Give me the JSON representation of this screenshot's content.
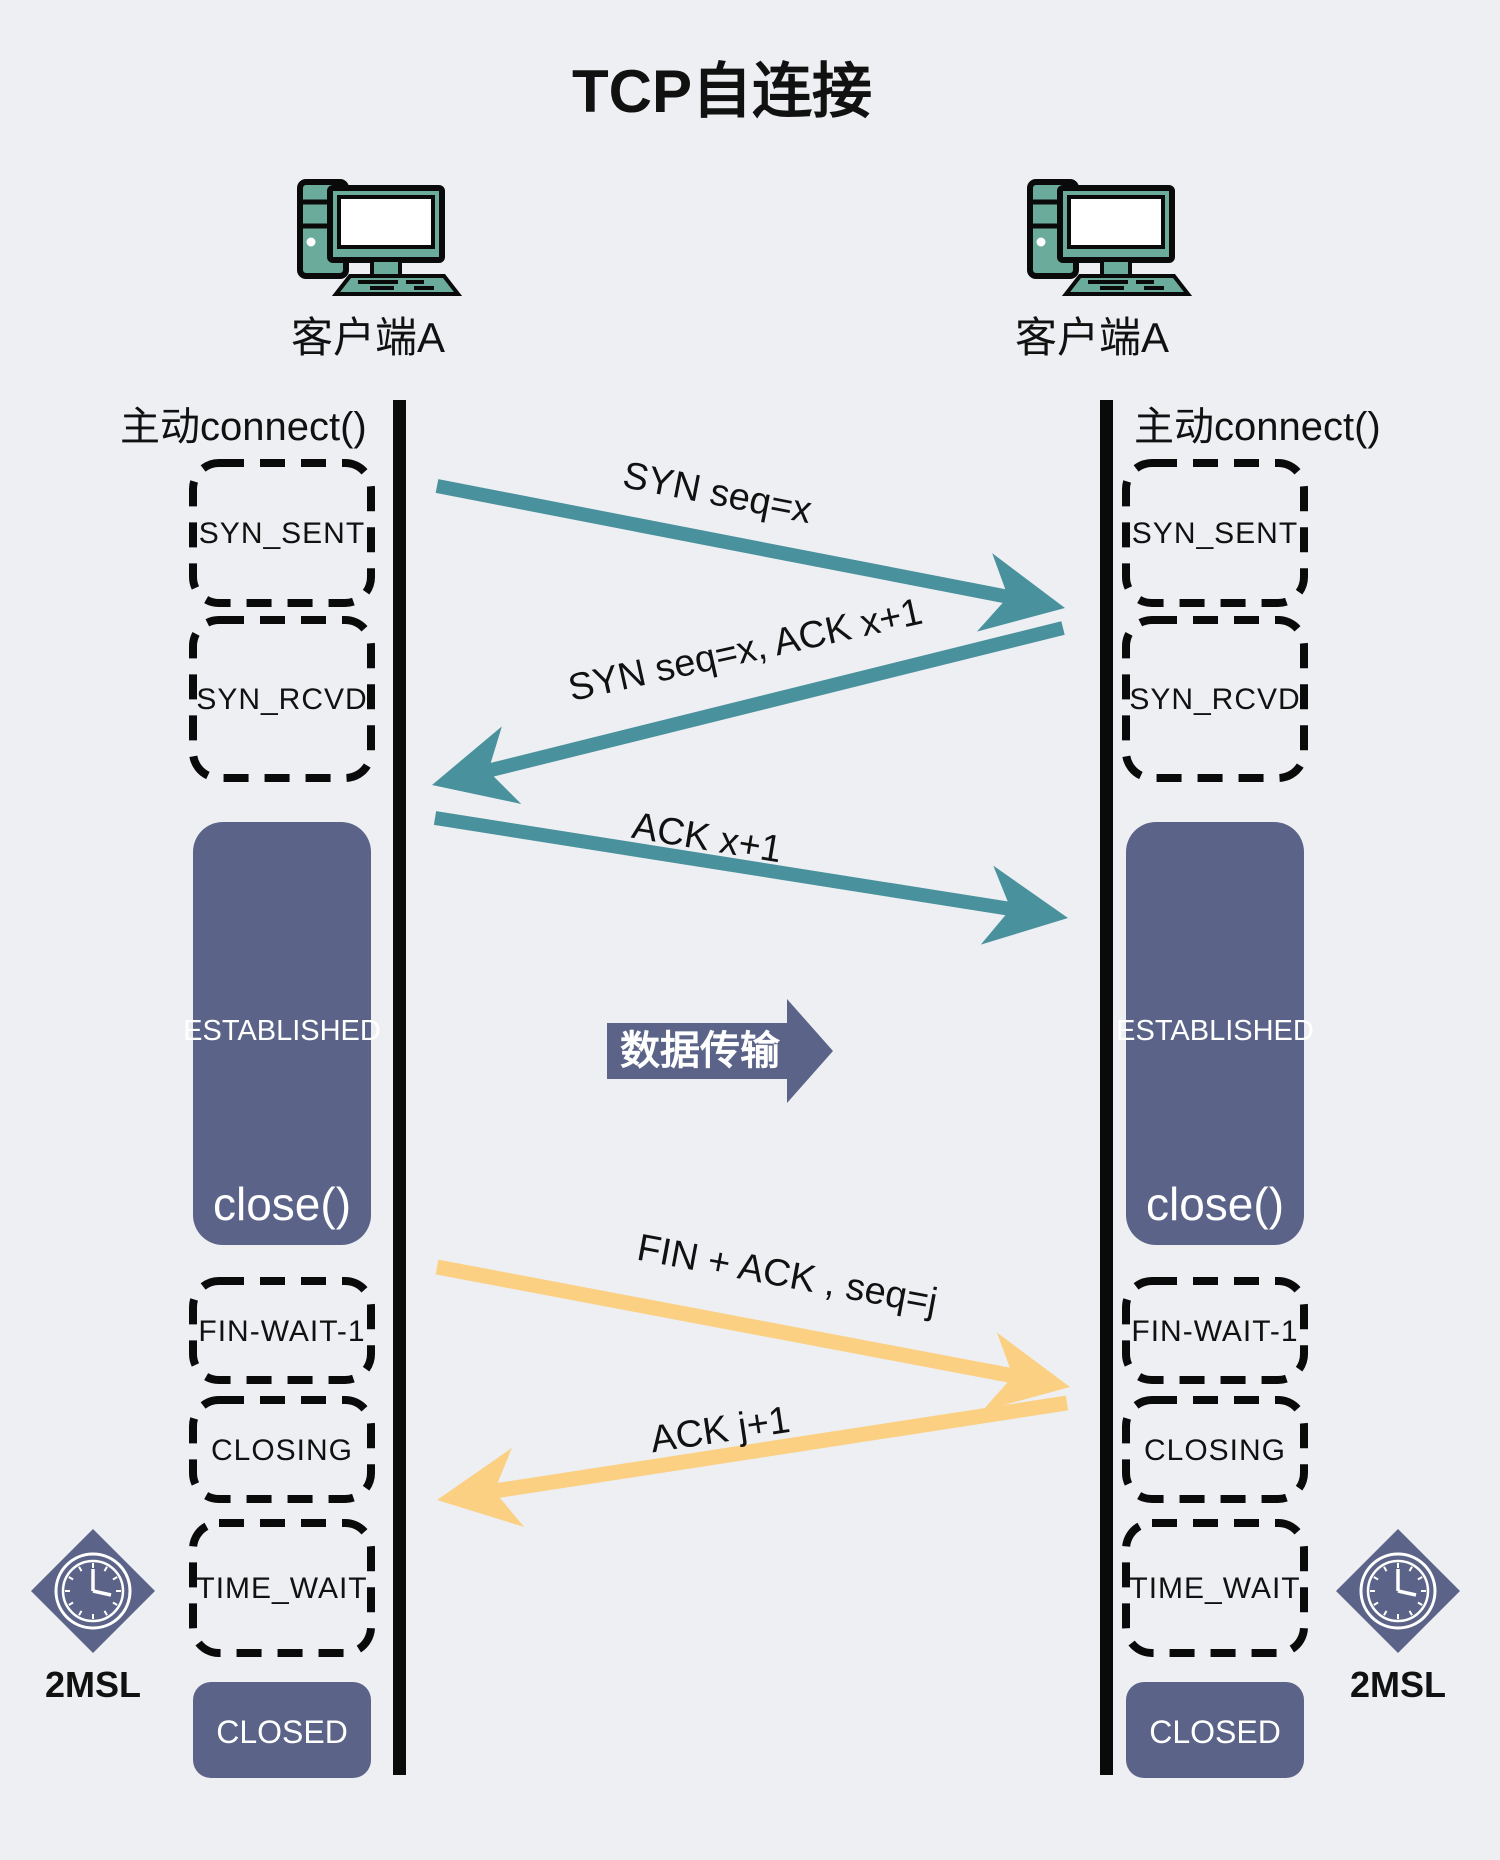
{
  "title": "TCP自连接",
  "colors": {
    "background": "#edeff2",
    "teal_arrow": "#4a919e",
    "slate": "#5b6488",
    "yellow_arrow": "#fbd083",
    "line_black": "#0a0a0a",
    "icon_teal": "#6aab9b",
    "text_dark": "#111111",
    "text_light": "#ffffff"
  },
  "clients": {
    "left": {
      "name": "客户端A",
      "action": "主动connect()",
      "timer": "2MSL"
    },
    "right": {
      "name": "客户端A",
      "action": "主动connect()",
      "timer": "2MSL"
    }
  },
  "states": {
    "syn_sent": "SYN_SENT",
    "syn_rcvd": "SYN_RCVD",
    "established": "ESTABLISHED",
    "close_call": "close()",
    "fin_wait_1": "FIN-WAIT-1",
    "closing": "CLOSING",
    "time_wait": "TIME_WAIT",
    "closed": "CLOSED"
  },
  "messages": {
    "syn": "SYN  seq=x",
    "syn_ack": "SYN seq=x, ACK x+1",
    "ack": "ACK  x+1",
    "data_transfer": "数据传输",
    "fin_ack": "FIN + ACK , seq=j",
    "ack_fin": "ACK j+1"
  }
}
